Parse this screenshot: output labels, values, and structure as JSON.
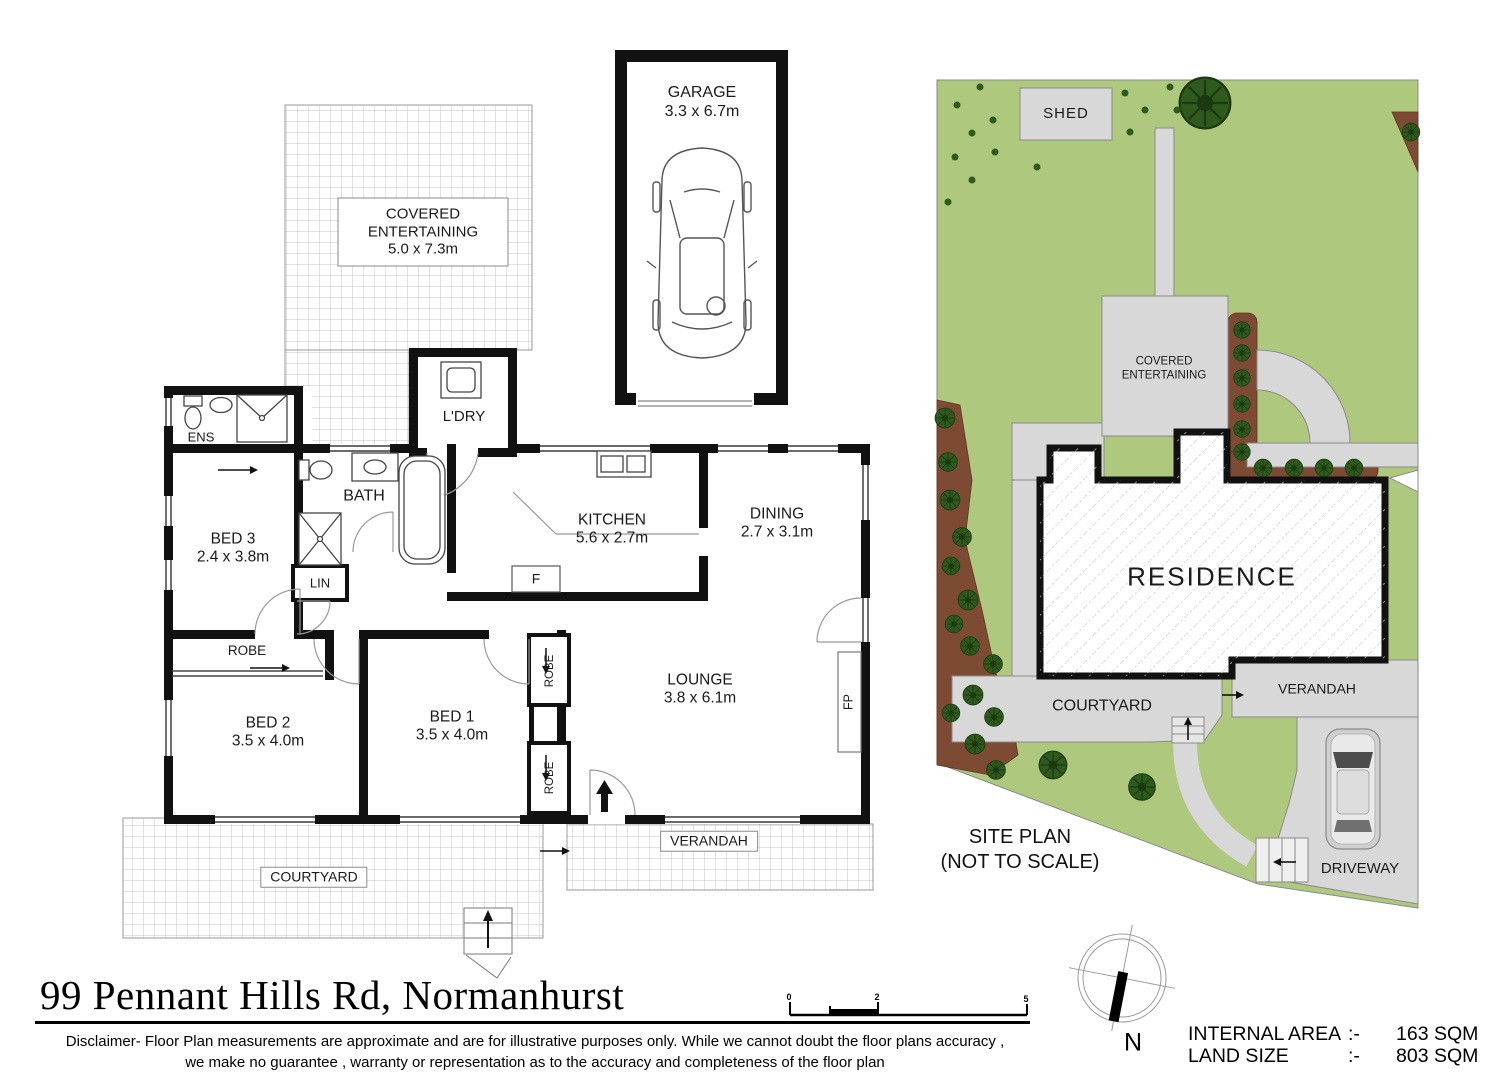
{
  "page": {
    "title": "99 Pennant Hills Rd, Normanhurst",
    "disclaimer1": "Disclaimer- Floor Plan measurements are approximate and are for illustrative purposes only. While we cannot doubt the floor plans accuracy ,",
    "disclaimer2": "we make no guarantee , warranty or representation as to the accuracy and completeness of the floor plan"
  },
  "floor_plan": {
    "garage": {
      "name": "GARAGE",
      "dims": "3.3 x 6.7m"
    },
    "covered_entertaining": {
      "name": "COVERED ENTERTAINING",
      "dims": "5.0 x 7.3m"
    },
    "laundry": {
      "name": "L'DRY"
    },
    "ens": {
      "name": "ENS"
    },
    "bath": {
      "name": "BATH"
    },
    "bed3": {
      "name": "BED 3",
      "dims": "2.4 x 3.8m"
    },
    "lin": {
      "name": "LIN"
    },
    "kitchen": {
      "name": "KITCHEN",
      "dims": "5.6 x 2.7m"
    },
    "dining": {
      "name": "DINING",
      "dims": "2.7 x 3.1m"
    },
    "lounge": {
      "name": "LOUNGE",
      "dims": "3.8 x 6.1m"
    },
    "bed2": {
      "name": "BED 2",
      "dims": "3.5 x 4.0m"
    },
    "bed1": {
      "name": "BED 1",
      "dims": "3.5 x 4.0m"
    },
    "robe_bed2": {
      "name": "ROBE"
    },
    "robe_bed1_top": {
      "name": "ROBE"
    },
    "robe_bed1_bottom": {
      "name": "ROBE"
    },
    "fridge": {
      "name": "F"
    },
    "fireplace": {
      "name": "FP"
    },
    "verandah": {
      "name": "VERANDAH"
    },
    "courtyard": {
      "name": "COURTYARD"
    }
  },
  "site_plan": {
    "shed": "SHED",
    "covered_entertaining": "COVERED ENTERTAINING",
    "residence": "RESIDENCE",
    "courtyard": "COURTYARD",
    "verandah": "VERANDAH",
    "driveway": "DRIVEWAY",
    "caption1": "SITE PLAN",
    "caption2": "(NOT TO SCALE)"
  },
  "scale_bar": {
    "t0": "0",
    "t2": "2",
    "t5": "5"
  },
  "compass": {
    "north": "N"
  },
  "areas": {
    "internal": {
      "label": "INTERNAL AREA",
      "sep": ":-",
      "value": "163 SQM"
    },
    "land": {
      "label": "LAND SIZE",
      "sep": ":-",
      "value": "803 SQM"
    }
  },
  "colors": {
    "wall": "#111111",
    "grass": "#aec97e",
    "garden_bed": "#7d4b33",
    "path_gray": "#d8d8d8",
    "tree": "#2e5b1d"
  }
}
